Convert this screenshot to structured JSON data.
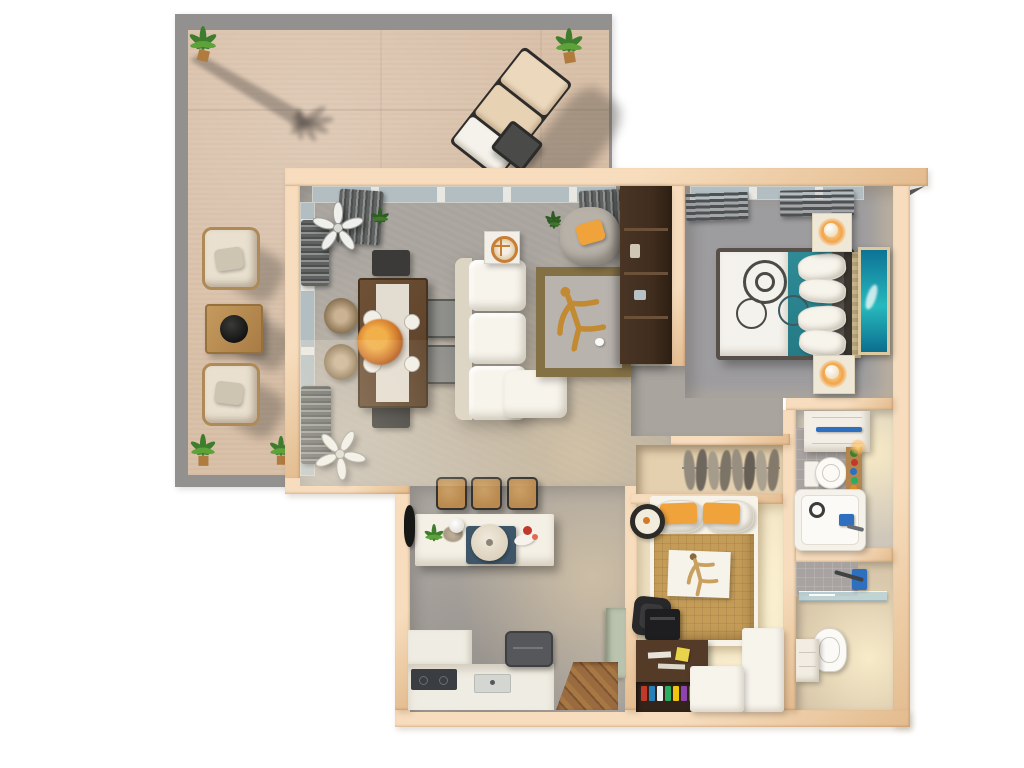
{
  "scene": {
    "type": "3d-floor-plan-top-down-render",
    "description": "Photorealistic top-down 3D rendering of an apartment floor plan with a large wrap-around terrace, open living-dining room, kitchen, master bedroom, walk-in closet, second bedroom with desk, and two bathrooms. No visible text labels.",
    "background": "#ffffff"
  },
  "colors": {
    "wall": "#f7ddbd",
    "wall-edge": "#e3bb8e",
    "terrace-floor": "#d9c0a8",
    "terrace-edge": "#939190",
    "shadow": "rgba(82,75,68,0.38)",
    "floor-gray": "#a9a49e",
    "carpet-gray": "#9d9c9e",
    "floor-warm": "#f2e5c6",
    "closet-floor": "#e4d0ae",
    "bath-floor": "#d9c8ab",
    "tile": "#a8a3a0",
    "cream": "#f4f0e6",
    "white": "#f7f4ec",
    "teal": "#2e8b96",
    "orange": "#f0a23b",
    "gold": "#c28a33",
    "rug-tan": "#c49c58",
    "olive": "#837044",
    "wood-dark": "#402d1e",
    "wood-desk": "#543b28",
    "wood-mid": "#6f5136",
    "wood-light": "#b9894f",
    "glass": "#b3bec2",
    "curtain": "#5f6261",
    "blue": "#2e6fc0",
    "sage": "#bac3ad",
    "plant-green": "#3f7d2e",
    "lamp-glow": "#f2a449"
  },
  "rooms": {
    "terrace": {
      "name": "Terrace",
      "furniture": [
        "potted plant (top-left)",
        "potted plant (top-right)",
        "potted plant (bottom-left)",
        "potted plant (bottom-right)",
        "sun lounger",
        "lounger side table",
        "armchair",
        "armchair",
        "coffee table with black bowl",
        "palm tree shadow"
      ]
    },
    "living": {
      "name": "Living and Dining Room",
      "furniture": [
        "ceiling fan",
        "ceiling fan",
        "window curtains",
        "windowsill plants",
        "dining table with white runner and orange floral centerpiece",
        "dining bench",
        "dining bench",
        "gray dining chair",
        "gray dining chair",
        "rattan dining chair",
        "rattan dining chair",
        "white three-seat sofa with chaise",
        "side table with round orange medallion plate",
        "gray armchair with orange pillow",
        "olive-bordered area rug with gold driftwood figure",
        "dark walnut media cabinet"
      ]
    },
    "kitchen": {
      "name": "Kitchen",
      "furniture": [
        "white island with plant, lamp, tray and round bread board",
        "bar stool",
        "bar stool",
        "bar stool",
        "white counter",
        "dark cooktop",
        "sink",
        "dark appliance top",
        "sage green tall cabinet",
        "diagonal wood entry floor",
        "black wall mirror"
      ]
    },
    "master_bedroom": {
      "name": "Master Bedroom",
      "furniture": [
        "double bed, white duvet with circle pattern and teal throw",
        "white pillows",
        "dark headboard",
        "nightstand with lit lamp",
        "nightstand with lit lamp",
        "teal wall-mounted TV artwork",
        "window blinds",
        "woven bedside runner"
      ]
    },
    "hallway": {
      "name": "Hallway",
      "furniture": []
    },
    "closet": {
      "name": "Walk-in Closet",
      "furniture": [
        "clothes rail with hanging garments",
        "empty shelf compartment"
      ]
    },
    "bedroom2": {
      "name": "Second Bedroom and Office",
      "furniture": [
        "bed with tan waffle duvet and two orange pillows",
        "person resting on white throw",
        "round black wall decor",
        "dark wood desk with yellow sticky note",
        "black office chair",
        "black printer",
        "bookshelf with colorful books",
        "white L-shaped storage unit"
      ]
    },
    "bathroom1": {
      "name": "En-suite Bathroom",
      "furniture": [
        "white vanity with blue towel rail",
        "toilet",
        "wooden shelf with plants and toiletries",
        "lit candle",
        "bathtub with drain and blue faucet"
      ]
    },
    "bathroom2": {
      "name": "Guest Bathroom",
      "furniture": [
        "walk-in shower with glass panel and blue fixture",
        "toilet",
        "white cabinet",
        "angled corner wall"
      ]
    }
  }
}
